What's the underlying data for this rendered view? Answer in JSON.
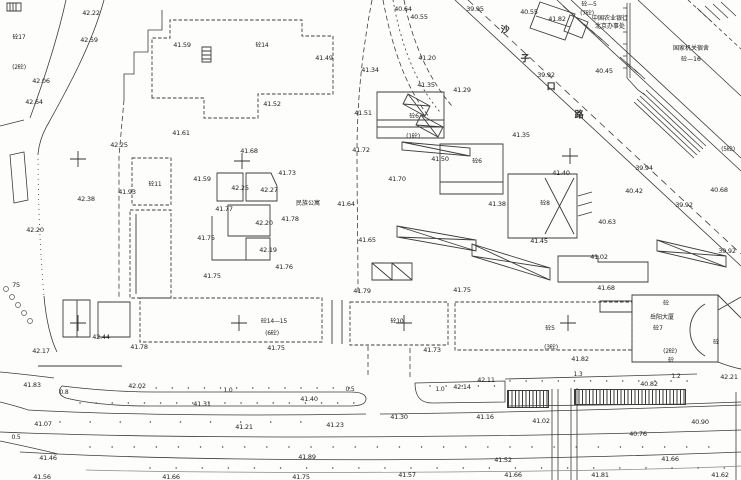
{
  "canvas": {
    "width": 741,
    "height": 480,
    "background": "#fdfdfc",
    "ink": "#3d3d3d"
  },
  "plan": {
    "place_names": {
      "apartment": {
        "t": "民族公寓",
        "x": 308,
        "y": 204
      },
      "bank": [
        {
          "t": "中国农业银行",
          "x": 610,
          "y": 19
        },
        {
          "t": "北京办事处",
          "x": 610,
          "y": 27
        }
      ],
      "dorm": [
        {
          "t": "国家机关宿舍",
          "x": 691,
          "y": 49
        },
        {
          "t": "砼—16",
          "x": 691,
          "y": 60
        }
      ],
      "tower": [
        {
          "t": "岳阳大厦",
          "x": 662,
          "y": 318
        },
        {
          "t": "砼7",
          "x": 658,
          "y": 329
        }
      ],
      "road_name_chars": [
        {
          "t": "沙",
          "x": 505,
          "y": 31
        },
        {
          "t": "子",
          "x": 525,
          "y": 60
        },
        {
          "t": "口",
          "x": 551,
          "y": 88
        },
        {
          "t": "路",
          "x": 579,
          "y": 116
        }
      ]
    },
    "building_codes": [
      {
        "t": "砼17",
        "x": 19,
        "y": 38
      },
      {
        "t": "(2砼)",
        "x": 19,
        "y": 68
      },
      {
        "t": "砼—5",
        "x": 589,
        "y": 5
      },
      {
        "t": "(7砼)",
        "x": 587,
        "y": 14
      },
      {
        "t": "砼14",
        "x": 262,
        "y": 46
      },
      {
        "t": "砼11",
        "x": 155,
        "y": 185
      },
      {
        "t": "砼6",
        "x": 414,
        "y": 117
      },
      {
        "t": "(1砼)",
        "x": 413,
        "y": 137
      },
      {
        "t": "砼6",
        "x": 477,
        "y": 162
      },
      {
        "t": "砼8",
        "x": 545,
        "y": 204
      },
      {
        "t": "砼14—15",
        "x": 274,
        "y": 322
      },
      {
        "t": "(6砼)",
        "x": 272,
        "y": 334
      },
      {
        "t": "砼10",
        "x": 397,
        "y": 322
      },
      {
        "t": "砼5",
        "x": 550,
        "y": 329
      },
      {
        "t": "(3砼)",
        "x": 551,
        "y": 348
      },
      {
        "t": "(2砼)",
        "x": 670,
        "y": 352
      },
      {
        "t": "(5砼)",
        "x": 728,
        "y": 150
      },
      {
        "t": "砼",
        "x": 666,
        "y": 304
      },
      {
        "t": "砼",
        "x": 671,
        "y": 361
      },
      {
        "t": "砼",
        "x": 716,
        "y": 343
      }
    ],
    "elevations": [
      {
        "t": "42.22",
        "x": 91,
        "y": 13
      },
      {
        "t": "42.59",
        "x": 89,
        "y": 40
      },
      {
        "t": "41.59",
        "x": 182,
        "y": 45
      },
      {
        "t": "40.64",
        "x": 403,
        "y": 9
      },
      {
        "t": "40.55",
        "x": 419,
        "y": 17
      },
      {
        "t": "39.95",
        "x": 475,
        "y": 9
      },
      {
        "t": "40.55",
        "x": 529,
        "y": 12
      },
      {
        "t": "41.82",
        "x": 557,
        "y": 19
      },
      {
        "t": "39.92",
        "x": 546,
        "y": 75
      },
      {
        "t": "40.45",
        "x": 604,
        "y": 71
      },
      {
        "t": "41.20",
        "x": 427,
        "y": 58
      },
      {
        "t": "41.49",
        "x": 324,
        "y": 58
      },
      {
        "t": "41.34",
        "x": 370,
        "y": 70
      },
      {
        "t": "41.35",
        "x": 426,
        "y": 85
      },
      {
        "t": "41.29",
        "x": 462,
        "y": 90
      },
      {
        "t": "41.52",
        "x": 272,
        "y": 104
      },
      {
        "t": "41.51",
        "x": 363,
        "y": 113
      },
      {
        "t": "41.35",
        "x": 521,
        "y": 135
      },
      {
        "t": "41.61",
        "x": 181,
        "y": 133
      },
      {
        "t": "42.25",
        "x": 119,
        "y": 145
      },
      {
        "t": "42.06",
        "x": 41,
        "y": 81
      },
      {
        "t": "42.64",
        "x": 34,
        "y": 102
      },
      {
        "t": "41.93",
        "x": 127,
        "y": 192
      },
      {
        "t": "42.38",
        "x": 86,
        "y": 199
      },
      {
        "t": "42.20",
        "x": 35,
        "y": 230
      },
      {
        "t": "41.68",
        "x": 249,
        "y": 151
      },
      {
        "t": "41.73",
        "x": 287,
        "y": 173
      },
      {
        "t": "41.59",
        "x": 202,
        "y": 179
      },
      {
        "t": "42.25",
        "x": 240,
        "y": 188
      },
      {
        "t": "42.27",
        "x": 269,
        "y": 190
      },
      {
        "t": "41.77",
        "x": 224,
        "y": 209
      },
      {
        "t": "42.20",
        "x": 264,
        "y": 223
      },
      {
        "t": "41.78",
        "x": 290,
        "y": 219
      },
      {
        "t": "41.64",
        "x": 346,
        "y": 204
      },
      {
        "t": "41.75",
        "x": 206,
        "y": 238
      },
      {
        "t": "42.19",
        "x": 268,
        "y": 250
      },
      {
        "t": "41.76",
        "x": 284,
        "y": 267
      },
      {
        "t": "41.75",
        "x": 212,
        "y": 276
      },
      {
        "t": "41.72",
        "x": 361,
        "y": 150
      },
      {
        "t": "41.50",
        "x": 440,
        "y": 159
      },
      {
        "t": "41.70",
        "x": 397,
        "y": 179
      },
      {
        "t": "41.38",
        "x": 497,
        "y": 204
      },
      {
        "t": "41.40",
        "x": 561,
        "y": 173
      },
      {
        "t": "39.94",
        "x": 644,
        "y": 168
      },
      {
        "t": "40.42",
        "x": 634,
        "y": 191
      },
      {
        "t": "39.92",
        "x": 684,
        "y": 205
      },
      {
        "t": "40.68",
        "x": 719,
        "y": 190
      },
      {
        "t": "39.92",
        "x": 727,
        "y": 251
      },
      {
        "t": "40.63",
        "x": 607,
        "y": 222
      },
      {
        "t": "41.45",
        "x": 539,
        "y": 241
      },
      {
        "t": "41.65",
        "x": 367,
        "y": 240
      },
      {
        "t": "41.02",
        "x": 599,
        "y": 257
      },
      {
        "t": "41.68",
        "x": 606,
        "y": 288
      },
      {
        "t": "41.79",
        "x": 362,
        "y": 291
      },
      {
        "t": "41.75",
        "x": 462,
        "y": 290
      },
      {
        "t": "42.44",
        "x": 101,
        "y": 337
      },
      {
        "t": "42.17",
        "x": 41,
        "y": 351
      },
      {
        "t": "41.78",
        "x": 139,
        "y": 347
      },
      {
        "t": "41.75",
        "x": 276,
        "y": 348
      },
      {
        "t": "41.73",
        "x": 432,
        "y": 350
      },
      {
        "t": "41.83",
        "x": 32,
        "y": 385
      },
      {
        "t": "42.02",
        "x": 137,
        "y": 386
      },
      {
        "t": "41.31",
        "x": 202,
        "y": 404
      },
      {
        "t": "41.40",
        "x": 309,
        "y": 399
      },
      {
        "t": "42.14",
        "x": 462,
        "y": 387
      },
      {
        "t": "42.11",
        "x": 486,
        "y": 380
      },
      {
        "t": "41.30",
        "x": 399,
        "y": 417
      },
      {
        "t": "41.16",
        "x": 485,
        "y": 417
      },
      {
        "t": "41.23",
        "x": 335,
        "y": 425
      },
      {
        "t": "41.07",
        "x": 43,
        "y": 424
      },
      {
        "t": "41.21",
        "x": 244,
        "y": 427
      },
      {
        "t": "41.46",
        "x": 48,
        "y": 458
      },
      {
        "t": "41.89",
        "x": 307,
        "y": 457
      },
      {
        "t": "41.56",
        "x": 42,
        "y": 477
      },
      {
        "t": "41.66",
        "x": 171,
        "y": 477
      },
      {
        "t": "41.75",
        "x": 301,
        "y": 477
      },
      {
        "t": "41.57",
        "x": 407,
        "y": 475
      },
      {
        "t": "41.66",
        "x": 513,
        "y": 475
      },
      {
        "t": "41.81",
        "x": 600,
        "y": 475
      },
      {
        "t": "41.62",
        "x": 720,
        "y": 475
      },
      {
        "t": "41.52",
        "x": 503,
        "y": 460
      },
      {
        "t": "41.66",
        "x": 670,
        "y": 459
      },
      {
        "t": "41.82",
        "x": 580,
        "y": 359
      },
      {
        "t": "42.21",
        "x": 729,
        "y": 377
      },
      {
        "t": "40.82",
        "x": 649,
        "y": 384
      },
      {
        "t": "40.90",
        "x": 700,
        "y": 422
      },
      {
        "t": "41.02",
        "x": 541,
        "y": 421
      },
      {
        "t": "40.76",
        "x": 638,
        "y": 434
      },
      {
        "t": "75",
        "x": 16,
        "y": 285
      }
    ],
    "road_widths": [
      {
        "t": "0.8",
        "x": 64,
        "y": 393
      },
      {
        "t": "1.0",
        "x": 228,
        "y": 391
      },
      {
        "t": "0.5",
        "x": 350,
        "y": 390
      },
      {
        "t": "1.0",
        "x": 440,
        "y": 390
      },
      {
        "t": "1.3",
        "x": 578,
        "y": 375
      },
      {
        "t": "1.2",
        "x": 676,
        "y": 377
      },
      {
        "t": "0.5",
        "x": 16,
        "y": 438
      }
    ]
  }
}
